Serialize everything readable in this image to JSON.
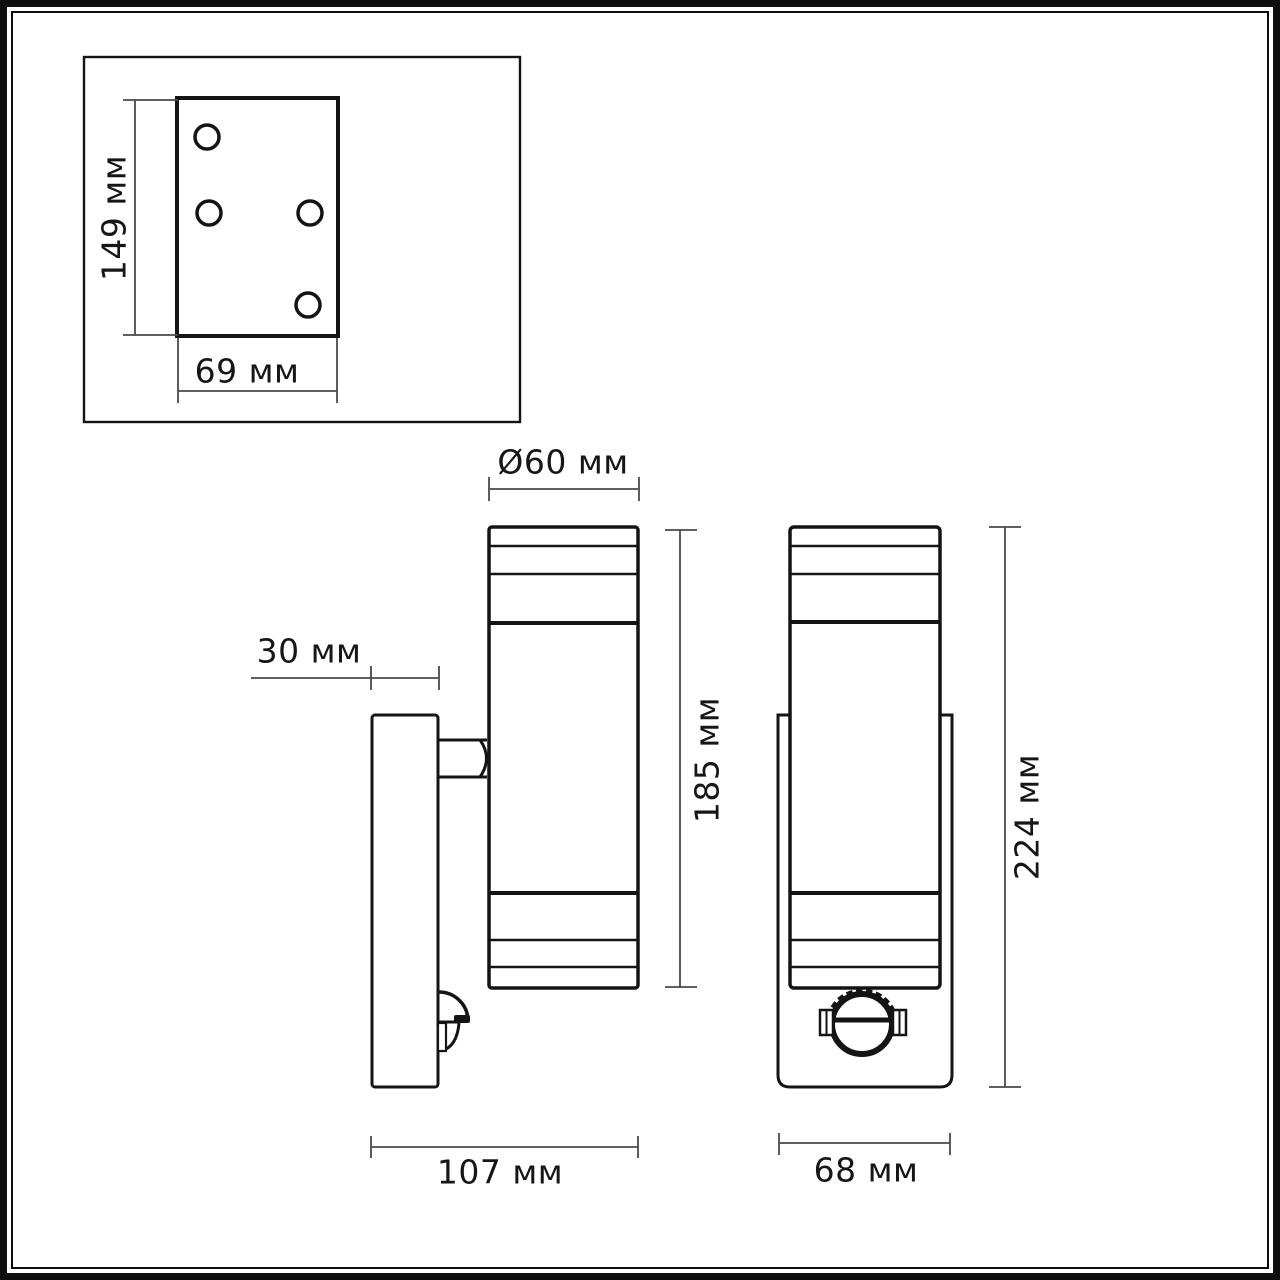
{
  "units": "мм",
  "colors": {
    "line": "#141414",
    "dimension_line": "#4a4a4a",
    "background": "#ffffff"
  },
  "mounting_plate_view": {
    "height": "149 мм",
    "width": "69 мм",
    "screw_hole_count": 4
  },
  "side_view": {
    "backplate_depth": "30 мм",
    "tube_diameter": "Ø60 мм",
    "tube_height": "185 мм",
    "overall_depth": "107 мм"
  },
  "front_view": {
    "overall_height": "224 мм",
    "backplate_width": "68 мм"
  }
}
